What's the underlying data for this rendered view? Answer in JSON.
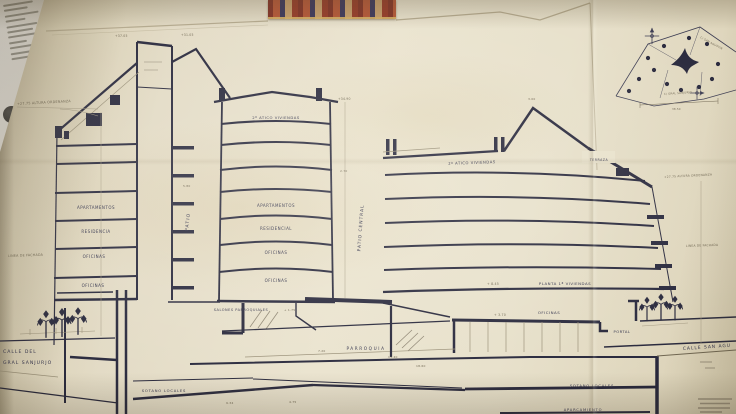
{
  "colors": {
    "paper": "#e8e1cb",
    "ink": "#26263a",
    "faint_ink": "#8f8673",
    "sticker_red": "#b04a2e"
  },
  "icons": {
    "street_lamp": "triple-globe-street-lamp",
    "north_arrow": "survey-north-arrow"
  },
  "annotations": {
    "alt_ordenanza_left": "+27.75 ALTURA ORDENANZA",
    "linea_fachada_left": "LINEA DE FACHADA",
    "alt_ordenanza_right": "+27.75 ALTURA ORDENANZA",
    "linea_fachada_right": "LINEA DE FACHADA",
    "elev_tower": "+37.05",
    "elev_gable": "+31.05",
    "elev_central_top": "+34.90",
    "dim_central_height": "2.70",
    "dim_patio": "5.80",
    "dim_ridge": "3.00",
    "elev_planta": "+ 8.45",
    "elev_oficinas": "+ 3.70",
    "elev_salones": "+ 1.75",
    "dim_a": "9.34",
    "dim_b": "4.75",
    "dim_c": "7.20",
    "dim_d": "11.40",
    "dim_e": "18.60"
  },
  "left_building": {
    "floors": [
      "APARTAMENTOS",
      "RESIDENCIA",
      "OFICINAS",
      "OFICINAS"
    ]
  },
  "patio": {
    "label": "PATIO"
  },
  "central_building": {
    "attic": "2º ATICO VIVIENDAS",
    "floors": [
      "APARTAMENTOS",
      "RESIDENCIAL",
      "OFICINAS",
      "OFICINAS"
    ]
  },
  "patio_central": {
    "label": "PATIO CENTRAL"
  },
  "right_building": {
    "attic": "2º ATICO VIVIENDAS",
    "terraza": "TERRAZA",
    "planta": "PLANTA 1ª VIVIENDAS",
    "oficinas": "OFICINAS",
    "portal": "PORTAL"
  },
  "ground": {
    "street_left_1": "CALLE DEL",
    "street_left_2": "GRAL SANJURJO",
    "street_right": "CALLE SAN AGU",
    "salones": "SALONES PARROQUIALES",
    "parroquia": "PARROQUIA",
    "sotano_left": "SOTANO LOCALES",
    "sotano_right": "SOTANO LOCALES",
    "aparcamiento": "APARCAMIENTO"
  },
  "site_plan": {
    "street_a": "C/ SAN AGUSTIN",
    "street_b": "C/ GRAL SANJURJO",
    "dim": "38.50"
  }
}
